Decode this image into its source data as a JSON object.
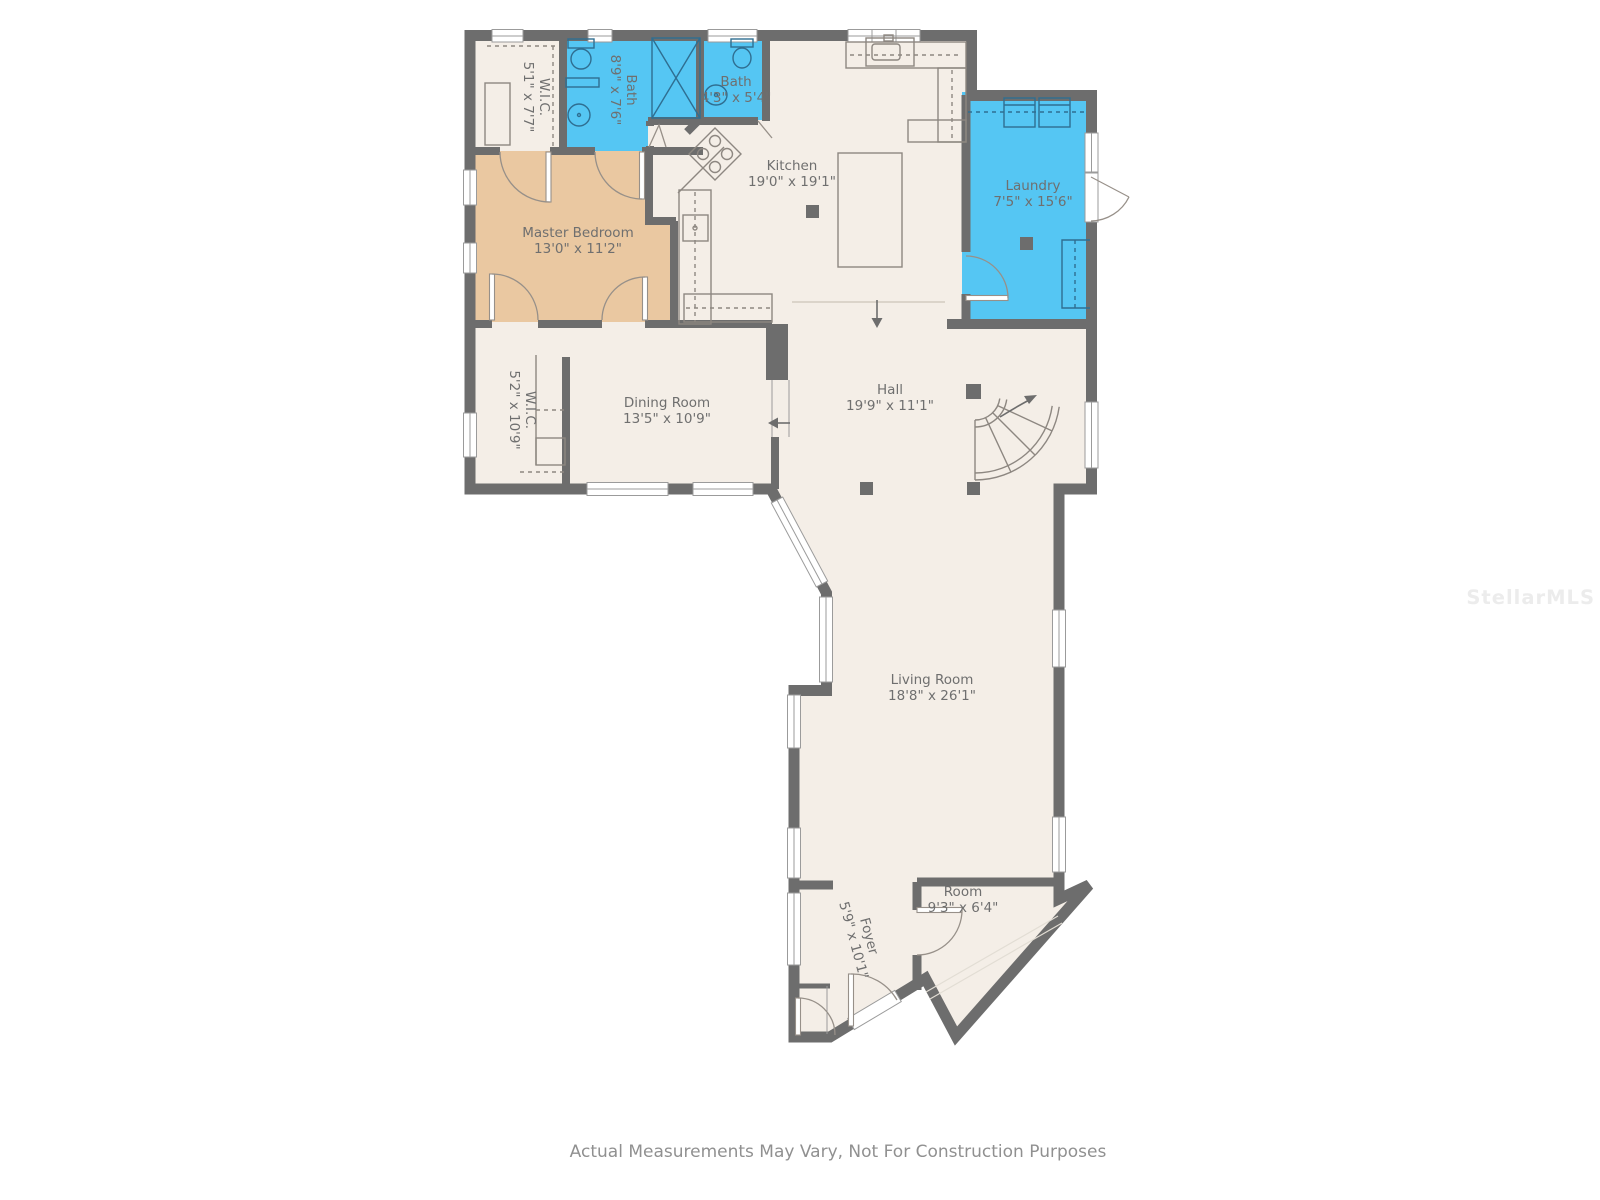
{
  "plan": {
    "disclaimer": "Actual Measurements May Vary, Not For Construction Purposes",
    "watermark": "StellarMLS"
  },
  "colors": {
    "wall": "#6d6d6d",
    "floor": "#f4eee7",
    "master_bedroom": "#eac8a1",
    "wet_rooms": "#55c6f3",
    "label_text": "#6f6f6f"
  },
  "rooms": [
    {
      "id": "wic1",
      "name": "W.I.C.",
      "dims": "5'1\" x 7'7\""
    },
    {
      "id": "bath1",
      "name": "Bath",
      "dims": "8'9\" x 7'6\""
    },
    {
      "id": "bath2",
      "name": "Bath",
      "dims": "4'3\" x 5'4\""
    },
    {
      "id": "kitchen",
      "name": "Kitchen",
      "dims": "19'0\" x 19'1\""
    },
    {
      "id": "laundry",
      "name": "Laundry",
      "dims": "7'5\" x 15'6\""
    },
    {
      "id": "master",
      "name": "Master Bedroom",
      "dims": "13'0\" x 11'2\""
    },
    {
      "id": "wic2",
      "name": "W.I.C.",
      "dims": "5'2\" x 10'9\""
    },
    {
      "id": "dining",
      "name": "Dining Room",
      "dims": "13'5\" x 10'9\""
    },
    {
      "id": "hall",
      "name": "Hall",
      "dims": "19'9\" x 11'1\""
    },
    {
      "id": "living",
      "name": "Living Room",
      "dims": "18'8\" x 26'1\""
    },
    {
      "id": "room",
      "name": "Room",
      "dims": "9'3\" x 6'4\""
    },
    {
      "id": "foyer",
      "name": "Foyer",
      "dims": "5'9\" x 10'1\""
    }
  ]
}
